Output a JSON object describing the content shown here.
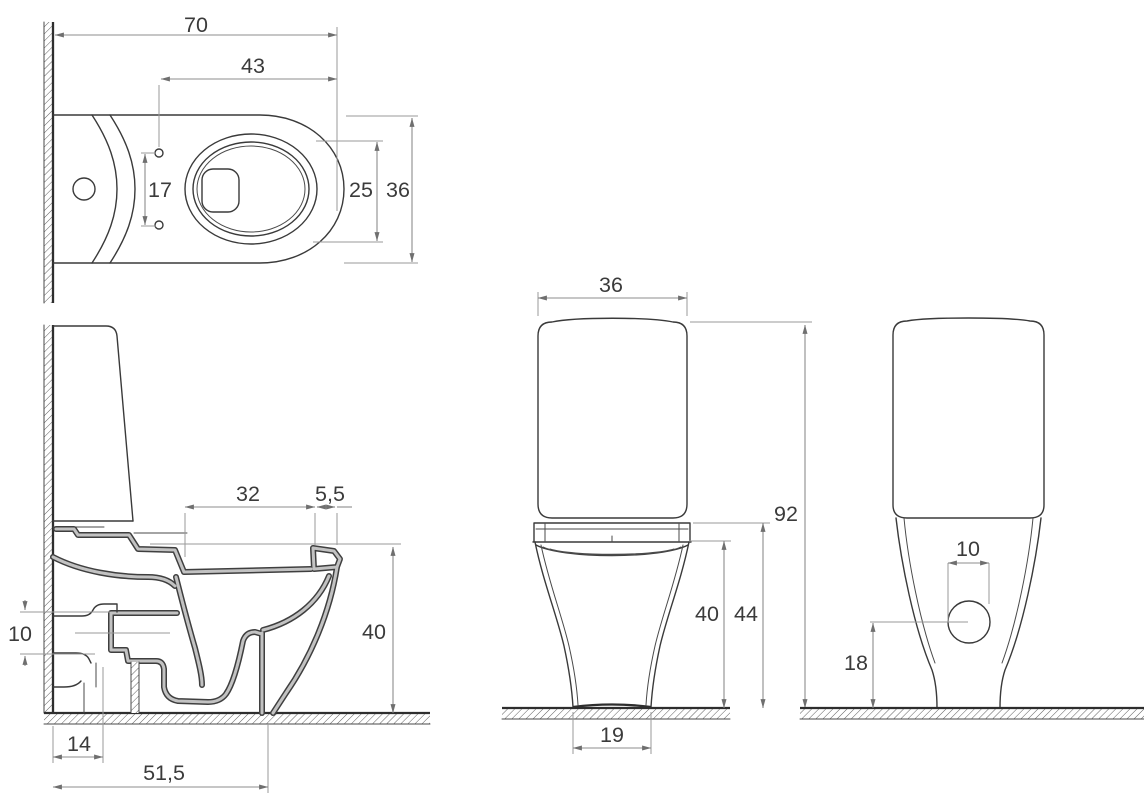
{
  "drawing": {
    "type": "technical-dimension-drawing",
    "subject": "close-coupled toilet, four orthographic views with dimensions",
    "colors": {
      "background": "#ffffff",
      "line": "#3a3a3a",
      "dimension": "#8c8c8c",
      "text": "#3b3b3b"
    },
    "views": {
      "top_view": {
        "name": "top view",
        "dims": {
          "depth": "70",
          "seat_depth": "43",
          "bolt_spacing": "17",
          "bowl_inner_width": "25",
          "width": "36"
        }
      },
      "side_view": {
        "name": "side section view",
        "dims": {
          "seat_opening": "32",
          "rim_width": "5,5",
          "bowl_height": "40",
          "outlet_size": "10",
          "outlet_center": "14",
          "trap_center": "51,5"
        }
      },
      "front_view": {
        "name": "front view",
        "dims": {
          "width": "36",
          "total_height": "92",
          "seat_height": "44",
          "bowl_height": "40",
          "base_width": "19"
        }
      },
      "back_view": {
        "name": "back view",
        "dims": {
          "outlet_width": "10",
          "outlet_height": "18"
        }
      }
    }
  }
}
